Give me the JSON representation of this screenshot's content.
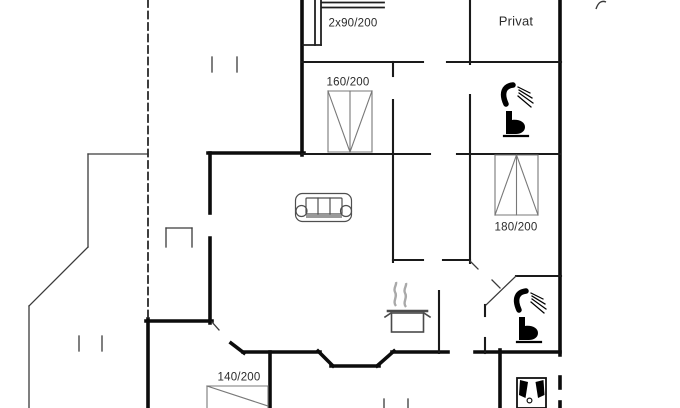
{
  "canvas": {
    "width": 680,
    "height": 408,
    "background": "#ffffff"
  },
  "colors": {
    "exterior_wall": "#0c0c0c",
    "interior_wall": "#1a1a1a",
    "thin_line": "#3a3a3a",
    "dashed_line": "#2a2a2a",
    "furniture_gray": "#777777",
    "icon_black": "#000000",
    "steam_gray": "#a9a9a9",
    "text": "#2b2b2b"
  },
  "labels": [
    {
      "name": "label-bunk-bed-size",
      "text": "2x90/200",
      "x": 353,
      "y": 24,
      "size": 11.5
    },
    {
      "name": "label-room-privat",
      "text": "Privat",
      "x": 516,
      "y": 21,
      "size": 13
    },
    {
      "name": "label-bed-160-size",
      "text": "160/200",
      "x": 348,
      "y": 83,
      "size": 11.5
    },
    {
      "name": "label-bed-180-size",
      "text": "180/200",
      "x": 516,
      "y": 228,
      "size": 11.5
    },
    {
      "name": "label-bed-140-size",
      "text": "140/200",
      "x": 239,
      "y": 378,
      "size": 11.5
    }
  ],
  "walls": [
    {
      "name": "exterior-walls",
      "color": "#0c0c0c",
      "width": 3.6,
      "segments": [
        [
          302,
          0,
          302,
          155
        ],
        [
          208,
          153,
          304,
          153
        ],
        [
          210,
          153,
          210,
          213
        ],
        [
          210,
          238,
          210,
          323
        ],
        [
          146,
          321,
          212,
          321
        ],
        [
          148,
          319,
          148,
          408
        ],
        [
          270,
          352,
          270,
          408
        ],
        [
          243,
          352,
          320,
          352
        ],
        [
          318,
          351,
          333,
          366
        ],
        [
          331,
          366,
          379,
          366
        ],
        [
          377,
          366,
          394,
          351
        ],
        [
          392,
          352,
          448,
          352
        ],
        [
          475,
          352,
          560,
          352
        ],
        [
          231,
          343,
          244,
          353
        ],
        [
          560,
          0,
          560,
          355
        ],
        [
          560,
          377,
          560,
          388
        ],
        [
          560,
          402,
          560,
          408
        ],
        [
          500,
          350,
          500,
          408
        ]
      ]
    },
    {
      "name": "interior-walls",
      "color": "#1a1a1a",
      "width": 2.1,
      "segments": [
        [
          302,
          62,
          423,
          62
        ],
        [
          447,
          62,
          561,
          62
        ],
        [
          393,
          62,
          393,
          76
        ],
        [
          393,
          100,
          393,
          262
        ],
        [
          470,
          0,
          470,
          64
        ],
        [
          470,
          95,
          470,
          263
        ],
        [
          302,
          154,
          430,
          154
        ],
        [
          457,
          154,
          560,
          154
        ],
        [
          393,
          260,
          423,
          260
        ],
        [
          443,
          260,
          470,
          260
        ],
        [
          516,
          276,
          561,
          276
        ],
        [
          439,
          291,
          439,
          353
        ],
        [
          485,
          305,
          485,
          316
        ],
        [
          485,
          338,
          485,
          353
        ]
      ]
    },
    {
      "name": "thin-lines",
      "color": "#3a3a3a",
      "width": 1.3,
      "segments": [
        [
          88,
          154,
          148,
          154
        ],
        [
          88,
          154,
          88,
          247
        ],
        [
          88,
          247,
          29,
          306
        ],
        [
          29,
          306,
          29,
          408
        ],
        [
          166,
          228,
          192,
          228
        ],
        [
          166,
          228,
          166,
          247
        ],
        [
          192,
          228,
          192,
          247
        ],
        [
          212,
          57,
          212,
          72
        ],
        [
          237,
          57,
          237,
          72
        ],
        [
          79,
          336,
          79,
          351
        ],
        [
          102,
          336,
          102,
          351
        ],
        [
          384,
          399,
          384,
          408
        ],
        [
          408,
          399,
          408,
          408
        ],
        [
          516,
          276,
          486,
          305
        ],
        [
          492,
          280,
          500,
          288
        ],
        [
          470,
          261,
          478,
          269
        ],
        [
          212,
          322,
          219,
          330
        ]
      ]
    },
    {
      "name": "terrace-dashed-line",
      "color": "#2a2a2a",
      "width": 1.8,
      "dash": "7 4.5",
      "segments": [
        [
          148,
          0,
          148,
          318
        ]
      ]
    }
  ],
  "furniture": [
    {
      "name": "bunk-bed",
      "color": "#1f1f1f",
      "stroke": 1.8,
      "segments": [
        [
          322,
          2.5,
          384,
          2.5
        ],
        [
          322,
          7.5,
          384,
          7.5
        ],
        [
          315,
          0,
          315,
          45
        ],
        [
          321,
          0,
          321,
          45
        ],
        [
          303,
          45,
          321,
          45
        ]
      ]
    },
    {
      "name": "double-bed-160",
      "color": "#787878",
      "stroke": 1.1,
      "segments": [
        [
          328,
          91,
          372,
          91
        ],
        [
          328,
          91,
          328,
          152
        ],
        [
          372,
          91,
          372,
          152
        ],
        [
          328,
          152,
          372,
          152
        ],
        [
          350,
          91,
          350,
          152
        ],
        [
          328,
          91,
          350,
          152
        ],
        [
          372,
          91,
          350,
          152
        ]
      ]
    },
    {
      "name": "double-bed-180",
      "color": "#787878",
      "stroke": 1.1,
      "segments": [
        [
          495,
          155,
          538,
          155
        ],
        [
          495,
          155,
          495,
          215
        ],
        [
          538,
          155,
          538,
          215
        ],
        [
          495,
          215,
          538,
          215
        ],
        [
          516.5,
          155,
          516.5,
          215
        ],
        [
          495,
          215,
          516.5,
          155
        ],
        [
          538,
          215,
          516.5,
          155
        ]
      ]
    },
    {
      "name": "bed-140",
      "color": "#787878",
      "stroke": 1.1,
      "segments": [
        [
          207,
          386,
          268,
          386
        ],
        [
          207,
          386,
          207,
          408
        ],
        [
          268,
          386,
          268,
          408
        ],
        [
          207,
          386,
          268,
          406
        ]
      ]
    },
    {
      "name": "sofa",
      "color": "#4f4f4f",
      "stroke": 1.2,
      "rects": [
        {
          "x": 295.5,
          "y": 193.5,
          "w": 56,
          "h": 28,
          "rx": 7
        },
        {
          "x": 306,
          "y": 198,
          "w": 36,
          "h": 16,
          "rx": 1
        },
        {
          "x": 306,
          "y": 214,
          "w": 36,
          "h": 4,
          "rx": 0,
          "fill": "#9a9a9a",
          "stroke": "none"
        }
      ],
      "circles": [
        {
          "cx": 301.5,
          "cy": 211,
          "r": 5.5
        },
        {
          "cx": 346,
          "cy": 211,
          "r": 5.5
        }
      ],
      "segments": [
        [
          318,
          198,
          318,
          214
        ],
        [
          330,
          198,
          330,
          214
        ]
      ]
    },
    {
      "name": "stove-pot",
      "color": "#4a4a4a",
      "stroke": 1.6,
      "paths": [
        {
          "d": "M396,306 c-4,-5 2,-9 -1,-14 c-2,-4 2,-7 1,-10",
          "stroke": "#a9a9a9",
          "sw": 2.4
        },
        {
          "d": "M406,307 c-4,-5 2,-9 -1,-14 c-2,-4 2,-7 1,-10",
          "stroke": "#a9a9a9",
          "sw": 2.4
        }
      ],
      "rects": [
        {
          "x": 391.5,
          "y": 313,
          "w": 32,
          "h": 19
        }
      ],
      "segments": [
        [
          388,
          311,
          427,
          311,
          2.6
        ],
        [
          391,
          313,
          385,
          317
        ],
        [
          424,
          313,
          430,
          317
        ]
      ]
    },
    {
      "name": "toilet-shower-icon-top",
      "color": "#000000",
      "paths": [
        {
          "d": "M506,104 C501,93 504,86 513,85",
          "stroke": "#000000",
          "sw": 5.5,
          "cap": "round"
        },
        {
          "d": "M506,111 h6 v9 c7,-1 13,2 13,7 c0,5 -5,7 -9,7 h-10 z",
          "fill": "#000000"
        }
      ],
      "segments": [
        [
          518,
          87,
          530,
          93,
          1.2
        ],
        [
          519,
          90,
          532,
          98,
          1.2
        ],
        [
          519,
          93,
          533,
          103,
          1.2
        ],
        [
          518,
          96,
          531,
          107,
          1.2
        ],
        [
          504,
          136,
          528,
          136,
          2.2
        ]
      ]
    },
    {
      "name": "toilet-shower-icon-bottom",
      "color": "#000000",
      "transform": "translate(13,206)",
      "paths": [
        {
          "d": "M506,104 C501,93 504,86 513,85",
          "stroke": "#000000",
          "sw": 5.5,
          "cap": "round"
        },
        {
          "d": "M506,111 h6 v9 c7,-1 13,2 13,7 c0,5 -5,7 -9,7 h-10 z",
          "fill": "#000000"
        }
      ],
      "segments": [
        [
          518,
          87,
          530,
          93,
          1.2
        ],
        [
          519,
          90,
          532,
          98,
          1.2
        ],
        [
          519,
          93,
          533,
          103,
          1.2
        ],
        [
          518,
          96,
          531,
          107,
          1.2
        ],
        [
          504,
          136,
          528,
          136,
          2.2
        ]
      ]
    },
    {
      "name": "washing-machine-icon",
      "color": "#111111",
      "stroke": 1.8,
      "rects": [
        {
          "x": 517,
          "y": 378,
          "w": 29,
          "h": 30
        }
      ],
      "paths": [
        {
          "d": "M520,380 L528,382 L525.5,398 L519,395 Z",
          "fill": "#000000"
        },
        {
          "d": "M543.5,380 L535.5,382 L538,398 L544.5,395 Z",
          "fill": "#000000"
        }
      ],
      "circles": [
        {
          "cx": 529.5,
          "cy": 400.5,
          "r": 2.4,
          "sw": 1.2
        }
      ]
    },
    {
      "name": "cut-off-mark-top-right",
      "color": "#3a3a3a",
      "paths": [
        {
          "d": "M596,9 C598,3 601,0 606,2",
          "stroke": "#3a3a3a",
          "sw": 1.4
        }
      ]
    }
  ]
}
